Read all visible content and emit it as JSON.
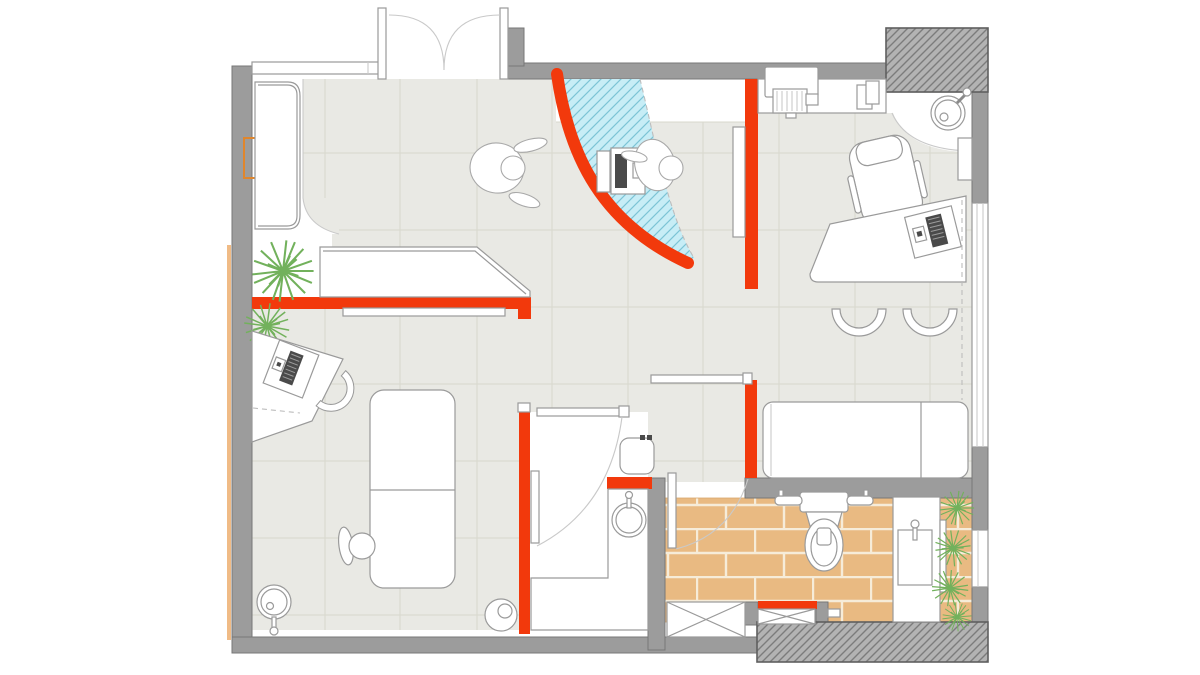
{
  "scene": "clinic-floor-plan",
  "description": "Top-down architectural floor plan of a small clinic with orange accent walls, curved glazed partition, tiled waiting area and brick-floored bathroom",
  "colors": {
    "accent": "#f2390c",
    "wall": "#9c9c9c",
    "wallEdge": "#777777",
    "hatchbg": "#b3b3b3",
    "hatchline": "#7c7c7c",
    "floor": "#e9e9e4",
    "grid": "#d8d8cd",
    "glass": "#c7edf6",
    "glasshatch": "#7cc4d6",
    "brick": "#e9ba82",
    "mortar": "#f6ecd9",
    "plant": "#72b15c",
    "line": "#9a9a9a",
    "softline": "#c9c9c9",
    "tan": "#f0bb86",
    "doormark": "#e0862c",
    "dark": "#4a4a4a"
  },
  "rooms": [
    "entrance-vestibule",
    "waiting-area",
    "consultation-room-left",
    "treatment-room-top-right",
    "recovery-room-right",
    "wash-room-center",
    "bathroom"
  ],
  "furniture": [
    "double-entrance-door",
    "wall-bench",
    "reception-desk",
    "check-in-kiosk",
    "standing-person",
    "person-at-kiosk",
    "curved-glass-partition",
    "printer",
    "paper-sheets",
    "corner-sink",
    "dental-chair",
    "doctor-desk",
    "laptop",
    "visitor-chair",
    "visitor-chair",
    "sliding-door",
    "exam-bed",
    "desk-chair",
    "work-desk",
    "stool",
    "round-sink",
    "waste-bin",
    "recovery-bed",
    "water-heater",
    "wash-counter",
    "wash-sink",
    "toilet",
    "grab-bars",
    "vanity-counter",
    "vanity-sink",
    "potted-plant",
    "planter-strip",
    "duct-shaft",
    "structural-column"
  ]
}
